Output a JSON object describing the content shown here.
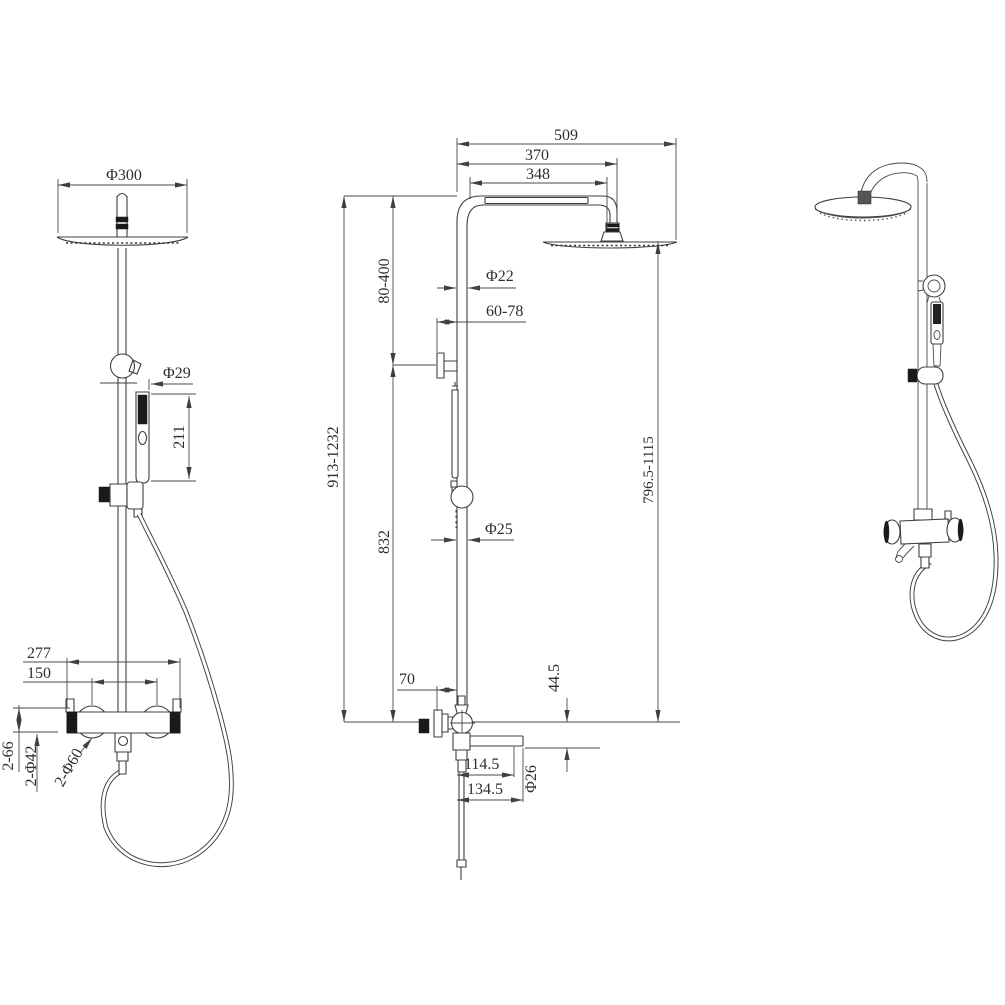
{
  "drawing": {
    "front": {
      "phi300": "Φ300",
      "phi29": "Φ29",
      "len211": "211",
      "w277": "277",
      "w150": "150",
      "h266": "2-66",
      "phi42": "2-Φ42",
      "phi60": "2-Φ60"
    },
    "side": {
      "w509": "509",
      "w370": "370",
      "w348": "348",
      "h80400": "80-400",
      "phi22": "Φ22",
      "d6078": "60-78",
      "h9131232": "913-1232",
      "h832": "832",
      "phi25": "Φ25",
      "h7965": "796.5-1115",
      "d70": "70",
      "d445": "44.5",
      "d1145": "114.5",
      "d1345": "134.5",
      "phi26": "Φ26"
    },
    "colors": {
      "line": "#3f3f3f",
      "text": "#2e2e2e",
      "fill_dark": "#1a1a1a",
      "background": "#ffffff"
    }
  }
}
